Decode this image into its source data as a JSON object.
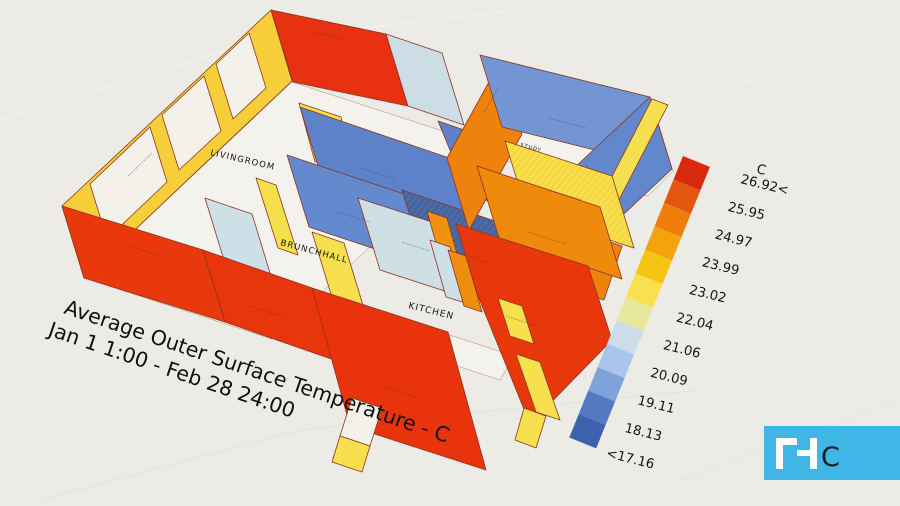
{
  "title": {
    "line1": "Average Outer Surface Temperature  - C",
    "line2": "Jan 1 1:00 - Feb 28 24:00"
  },
  "rooms": {
    "livingroom": "LIVINGROOM",
    "brunchhall": "BRUNCHHALL",
    "kitchen": "KITCHEN",
    "study": "STUDY"
  },
  "legend": {
    "header": "C",
    "labels": [
      "26.92<",
      "25.95",
      "24.97",
      "23.99",
      "23.02",
      "22.04",
      "21.06",
      "20.09",
      "19.11",
      "18.13",
      "<17.16"
    ],
    "colors": [
      "#d8290f",
      "#e4560d",
      "#ee7d0b",
      "#f3a30d",
      "#f6c412",
      "#f8e04e",
      "#e8e89c",
      "#cddde7",
      "#a9c5e9",
      "#7fa2da",
      "#5478c2",
      "#3e62ae"
    ]
  },
  "logo": {
    "letter": "C",
    "background": "#3fb6e6"
  },
  "palette": {
    "background": "#edebe5",
    "hot_wall_red": "#e8380b",
    "warm_wall_orange": "#ee850d",
    "warm_wall_yellow": "#f6ce3a",
    "cool_wall_blue": "#5e82c9",
    "cool_wall_lightblue": "#cfdfe6",
    "cold_wall_navy": "#46659f",
    "floor_white": "#f4f2ec"
  },
  "chart_data": {
    "type": "heatmap",
    "title": "Average Outer Surface Temperature  - C",
    "subtitle": "Jan 1 1:00 - Feb 28 24:00",
    "unit": "C",
    "colorbar_boundaries": [
      17.16,
      18.13,
      19.11,
      20.09,
      21.06,
      22.04,
      23.02,
      23.99,
      24.97,
      25.95,
      26.92
    ],
    "colorbar_range_note": "top bin >26.92, bottom bin <17.16",
    "legend_position": "right",
    "rooms": [
      "LIVINGROOM",
      "BRUNCHHALL",
      "KITCHEN",
      "STUDY"
    ]
  }
}
